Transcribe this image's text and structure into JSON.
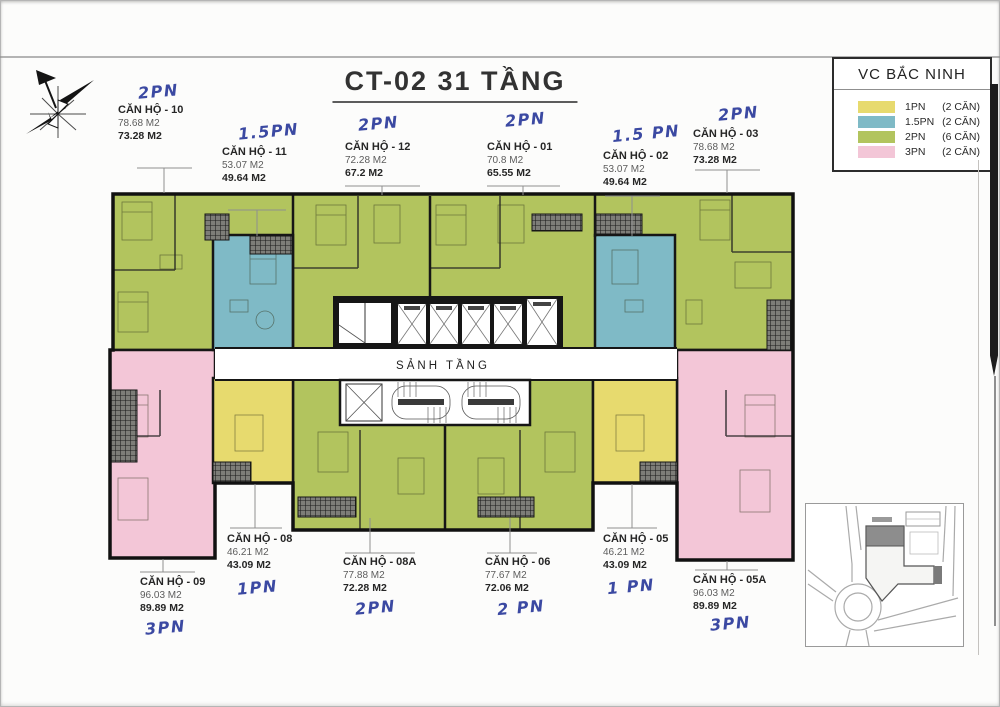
{
  "title": "CT-02  31 TẦNG",
  "legend": {
    "title": "VC BẮC NINH",
    "items": [
      {
        "label": "1PN",
        "count": "(2 CĂN)",
        "color": "#e7da6e"
      },
      {
        "label": "1.5PN",
        "count": "(2 CĂN)",
        "color": "#7fbac6"
      },
      {
        "label": "2PN",
        "count": "(6 CĂN)",
        "color": "#b2c45e"
      },
      {
        "label": "3PN",
        "count": "(2 CĂN)",
        "color": "#f3c6d7"
      }
    ]
  },
  "plan": {
    "lobby_label": "SẢNH TẦNG"
  },
  "colors": {
    "handwriting": "#2b3a9b",
    "wall": "#161616"
  },
  "units": [
    {
      "name": "CĂN HỘ - 10",
      "gross": "78.68 M2",
      "net": "73.28 M2",
      "note": "2PN"
    },
    {
      "name": "CĂN HỘ - 11",
      "gross": "53.07 M2",
      "net": "49.64 M2",
      "note": "1.5PN"
    },
    {
      "name": "CĂN HỘ - 12",
      "gross": "72.28 M2",
      "net": "67.2 M2",
      "note": "2PN"
    },
    {
      "name": "CĂN HỘ - 01",
      "gross": "70.8 M2",
      "net": "65.55 M2",
      "note": "2PN"
    },
    {
      "name": "CĂN HỘ - 02",
      "gross": "53.07 M2",
      "net": "49.64 M2",
      "note": "1.5 PN"
    },
    {
      "name": "CĂN HỘ - 03",
      "gross": "78.68 M2",
      "net": "73.28 M2",
      "note": "2PN"
    },
    {
      "name": "CĂN HỘ - 08",
      "gross": "46.21 M2",
      "net": "43.09 M2",
      "note": "1PN"
    },
    {
      "name": "CĂN HỘ - 08A",
      "gross": "77.88 M2",
      "net": "72.28 M2",
      "note": "2PN"
    },
    {
      "name": "CĂN HỘ - 06",
      "gross": "77.67 M2",
      "net": "72.06 M2",
      "note": "2 PN"
    },
    {
      "name": "CĂN HỘ - 05",
      "gross": "46.21 M2",
      "net": "43.09 M2",
      "note": "1 PN"
    },
    {
      "name": "CĂN HỘ - 09",
      "gross": "96.03 M2",
      "net": "89.89 M2",
      "note": "3PN"
    },
    {
      "name": "CĂN HỘ - 05A",
      "gross": "96.03 M2",
      "net": "89.89 M2",
      "note": "3PN"
    }
  ]
}
